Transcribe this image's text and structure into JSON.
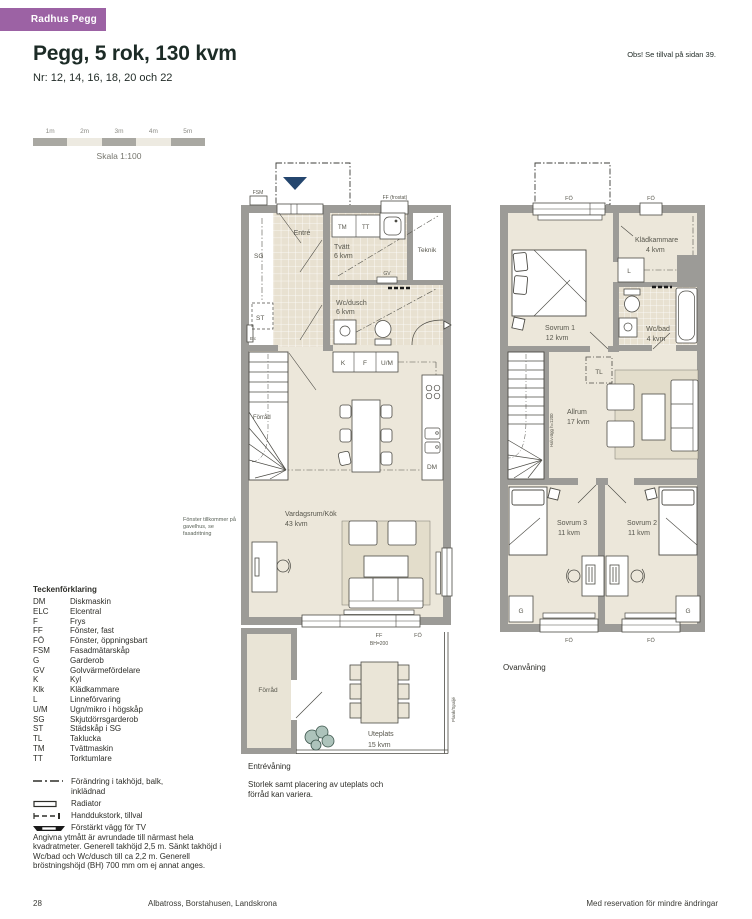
{
  "page": {
    "badge": "Radhus Pegg",
    "title": "Pegg, 5 rok, 130 kvm",
    "subtitle": "Nr: 12, 14, 16, 18, 20 och 22",
    "note_right": "Obs! Se tillval på sidan 39.",
    "page_number": "28",
    "footer_center": "Albatross, Borstahusen, Landskrona",
    "footer_right": "Med reservation för mindre ändringar"
  },
  "colors": {
    "accent_purple": "#9c62a4",
    "wall_gray": "#9c9b97",
    "floor_beige": "#ece7da",
    "tile_beige": "#e8e1d1",
    "entry_arrow_navy": "#24466e"
  },
  "scalebar": {
    "labels": [
      "1m",
      "2m",
      "3m",
      "4m",
      "5m"
    ],
    "caption": "Skala 1:100"
  },
  "plan1": {
    "floor_label": "Entrévåning",
    "variation_note": "Storlek samt placering av uteplats och förråd kan variera.",
    "annotation": "Fönster tillkommer på gavelhus, se fasadritning",
    "labels": {
      "fsm": "FSM",
      "ff_frostat": "FF (frostat)",
      "entre": "Entré",
      "sg": "SG",
      "st": "ST",
      "elc": "Elc",
      "tm": "TM",
      "tt": "TT",
      "teknik": "Teknik",
      "gv": "GV",
      "k": "K",
      "f": "F",
      "um": "U/M",
      "dm": "DM",
      "forrad_stair": "Förråd",
      "forrad_shed": "Förråd",
      "ff": "FF",
      "bh": "BH=200",
      "fo": "FÖ",
      "plank": "Plank/Spaljé"
    },
    "rooms": {
      "tvatt": {
        "name": "Tvätt",
        "area": "6 kvm"
      },
      "wcdusch": {
        "name": "Wc/dusch",
        "area": "6 kvm"
      },
      "vardagsrum": {
        "name": "Vardagsrum/Kök",
        "area": "43 kvm"
      },
      "uteplats": {
        "name": "Uteplats",
        "area": "15 kvm"
      }
    }
  },
  "plan2": {
    "floor_label": "Ovanvåning",
    "labels": {
      "fo_top_left": "FÖ",
      "fo_top_right": "FÖ",
      "fo_bottom_left": "FÖ",
      "fo_bottom_right": "FÖ",
      "l": "L",
      "tl": "TL",
      "g_left": "G",
      "g_right": "G",
      "halvvagg": "Halvvägg h=1200"
    },
    "rooms": {
      "sovrum1": {
        "name": "Sovrum 1",
        "area": "12 kvm"
      },
      "kladkammare": {
        "name": "Klädkammare",
        "area": "4 kvm"
      },
      "wcbad": {
        "name": "Wc/bad",
        "area": "4 kvm"
      },
      "allrum": {
        "name": "Allrum",
        "area": "17 kvm"
      },
      "sovrum3": {
        "name": "Sovrum 3",
        "area": "11 kvm"
      },
      "sovrum2": {
        "name": "Sovrum 2",
        "area": "11 kvm"
      }
    }
  },
  "legend": {
    "title": "Teckenförklaring",
    "items": [
      {
        "abbr": "DM",
        "desc": "Diskmaskin"
      },
      {
        "abbr": "ELC",
        "desc": "Elcentral"
      },
      {
        "abbr": "F",
        "desc": "Frys"
      },
      {
        "abbr": "FF",
        "desc": "Fönster, fast"
      },
      {
        "abbr": "FÖ",
        "desc": "Fönster, öppningsbart"
      },
      {
        "abbr": "FSM",
        "desc": "Fasadmätarskåp"
      },
      {
        "abbr": "G",
        "desc": "Garderob"
      },
      {
        "abbr": "GV",
        "desc": "Golvvärmefördelare"
      },
      {
        "abbr": "K",
        "desc": "Kyl"
      },
      {
        "abbr": "Klk",
        "desc": "Klädkammare"
      },
      {
        "abbr": "L",
        "desc": "Linneförvaring"
      },
      {
        "abbr": "U/M",
        "desc": "Ugn/mikro i högskåp"
      },
      {
        "abbr": "SG",
        "desc": "Skjutdörrsgarderob"
      },
      {
        "abbr": "ST",
        "desc": "Städskåp i SG"
      },
      {
        "abbr": "TL",
        "desc": "Taklucka"
      },
      {
        "abbr": "TM",
        "desc": "Tvättmaskin"
      },
      {
        "abbr": "TT",
        "desc": "Torktumlare"
      }
    ]
  },
  "symbols": {
    "items": [
      {
        "name": "ceiling-change",
        "label": "Förändring i takhöjd, balk, inklädnad"
      },
      {
        "name": "radiator",
        "label": "Radiator"
      },
      {
        "name": "towel-dryer",
        "label": "Handdukstork, tillval"
      },
      {
        "name": "tv-wall",
        "label": "Förstärkt vägg för TV"
      }
    ]
  },
  "footnote": "Angivna ytmått är avrundade till närmast hela kvadratmeter. Generell takhöjd 2,5 m. Sänkt takhöjd i Wc/bad och Wc/dusch till ca 2,2 m. Generell bröstningshöjd (BH) 700 mm om ej annat anges."
}
